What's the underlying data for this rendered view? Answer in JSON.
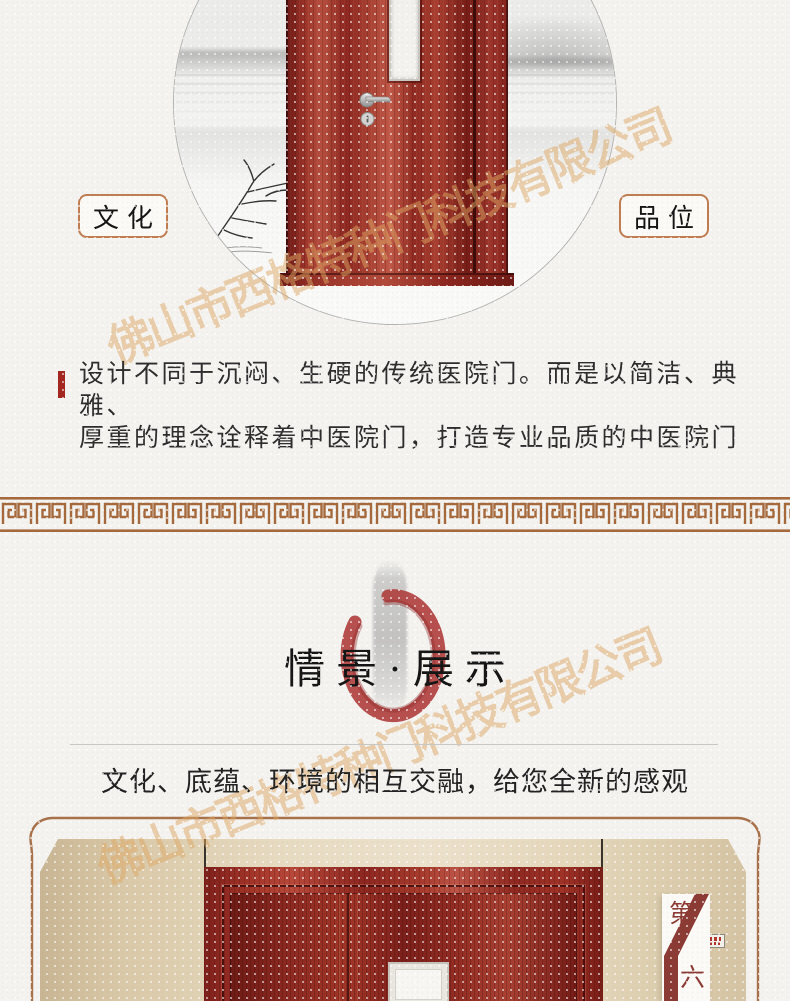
{
  "watermark": {
    "text": "佛山市西格特种门科技有限公司",
    "color": "#deA864"
  },
  "hero": {
    "label_left": "文化",
    "label_right": "品位",
    "door_color": "#9c352b",
    "scene": "ink-wash-lake-landscape"
  },
  "intro": {
    "accent_color": "#a3261f",
    "line1": "设计不同于沉闷、生硬的传统医院门。而是以简洁、典雅、",
    "line2": "厚重的理念诠释着中医院门，打造专业品质的中医院门"
  },
  "divider": {
    "pattern": "greek-key-meander",
    "color": "#a5693c"
  },
  "showcase": {
    "title": "情景·展示",
    "subtitle": "文化、底蕴、环境的相互交融，给您全新的感观",
    "enso_color": "#b04140",
    "frame_color": "#a8714a",
    "badge_top": "第",
    "badge_bottom": "六",
    "badge_color": "#8c3a34"
  }
}
